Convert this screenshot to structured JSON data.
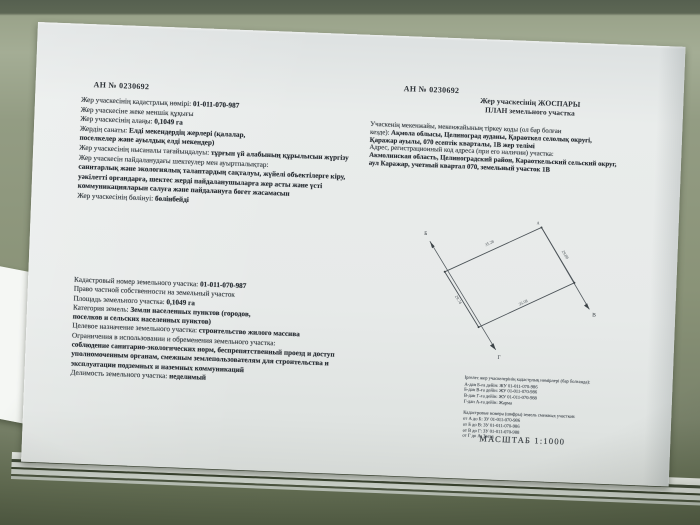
{
  "doc": {
    "number_left": "АН № 0230692",
    "number_right": "АН № 0230692"
  },
  "left_kk": {
    "lines": [
      {
        "pre": "Жер учаскесінің кадастрлық нөмірі: ",
        "bold": "01-011-070-987"
      },
      {
        "pre": "Жер учаскесіне жеке меншік құқығы",
        "bold": ""
      },
      {
        "pre": "Жер учаскесінің алаңы: ",
        "bold": "0,1049 га"
      },
      {
        "pre": "Жердің санаты: ",
        "bold": "Елді мекендердің жерлері (қалалар,"
      },
      {
        "pre": "",
        "bold": "поселкелер және ауылдық елді мекендер)"
      },
      {
        "pre": "Жер учаскесінің нысаналы тағайындалуы: ",
        "bold": "тұрғын үй алабының құрылысын жүргізу"
      },
      {
        "pre": "Жер учаскесін пайдаланудағы шектеулер мен ауыртпалықтар:",
        "bold": ""
      },
      {
        "pre": "",
        "bold": "санитарлық және экологиялық талаптардың сақталуы, жүйелі объектілерге кіру,"
      },
      {
        "pre": "",
        "bold": "уәкілетті органдарға, шектес жерді пайдаланушыларға жер асты және үсті"
      },
      {
        "pre": "",
        "bold": "коммуникацияларын салуға және пайдалануға бөгет жасамасын"
      },
      {
        "pre": "Жер учаскесінің бөлінуі: ",
        "bold": "бөлінбейді"
      }
    ]
  },
  "left_ru": {
    "lines": [
      {
        "pre": "Кадастровый номер земельного участка: ",
        "bold": "01-011-070-987"
      },
      {
        "pre": "Право частной собственности на земельный участок",
        "bold": ""
      },
      {
        "pre": "Площадь земельного участка: ",
        "bold": "0,1049 га"
      },
      {
        "pre": "Категория земель: ",
        "bold": "Земли населенных пунктов (городов,"
      },
      {
        "pre": "",
        "bold": "поселков и сельских населенных пунктов)"
      },
      {
        "pre": "Целевое назначение земельного участка: ",
        "bold": "строительство жилого массива"
      },
      {
        "pre": "Ограничения в использовании и обременения земельного участка:",
        "bold": ""
      },
      {
        "pre": "",
        "bold": "соблюдение санитарно-экологических норм, беспрепятственный проезд и доступ"
      },
      {
        "pre": "",
        "bold": "уполномоченным органам, смежным землепользователям для строительства и"
      },
      {
        "pre": "",
        "bold": "эксплуатации подземных и наземных коммуникаций"
      },
      {
        "pre": "Делимость  земельного участка: ",
        "bold": "неделимый"
      }
    ]
  },
  "plan": {
    "title_kk": "Жер учаскесінің ЖОСПАРЫ",
    "title_ru": "ПЛАН земельного участка",
    "address_lines": [
      {
        "pre": "Учаскенің мекенжайы, мекенжайының тіркеу коды (ол бар болған",
        "bold": ""
      },
      {
        "pre": "кезде): ",
        "bold": "Ақмола облысы, Целиноград ауданы, Қараөткел селолық округі,"
      },
      {
        "pre": "",
        "bold": "Қаражар ауылы, 070 есептік кварталы, 1В жер телімі"
      },
      {
        "pre": "Адрес, регистрационный код адреса (при его наличии) участка:",
        "bold": ""
      },
      {
        "pre": "",
        "bold": "Акмолинская область, Целиноградский район, Караоткельский сельский округ,"
      },
      {
        "pre": "",
        "bold": "аул Каражар, учетный квартал 070, земельный участок 1В"
      }
    ],
    "dims": {
      "top": "35.28",
      "right": "29.88",
      "bottom": "35.08",
      "left": "29.74"
    },
    "corner_labels": {
      "upper_left": "Б",
      "right": "В",
      "bottom": "Г",
      "top": "А"
    },
    "scale": "МАСШТАБ 1:1000"
  },
  "notes": {
    "kk_header": "Іргелес жер учаскелерінің кадастрлық нөмірлері (бар болғанда):",
    "kk_lines": [
      "А-дан Б-ға дейін: ЖУ 01-011-070-986",
      "Б-дан В-ға дейін: ЖУ 01-011-070-986",
      "В-дан Г-ға дейін: ЖУ 01-011-070-988",
      "Г-дан А-ға дейін: Жарма"
    ],
    "ru_header": "Кадастровые номера (шифры) земель смежных участков:",
    "ru_lines": [
      "от А до Б: ЗУ 01-011-070-986",
      "от Б до В: ЗУ 01-011-070-986",
      "от В до Г: ЗУ 01-011-070-988",
      "от Г до А: Заезд"
    ]
  },
  "colors": {
    "paper": "#e7eae9",
    "ink": "#3a4045",
    "ink_bold": "#2b3036",
    "sill_green": "#8a9378",
    "wall_dark": "#566050"
  }
}
